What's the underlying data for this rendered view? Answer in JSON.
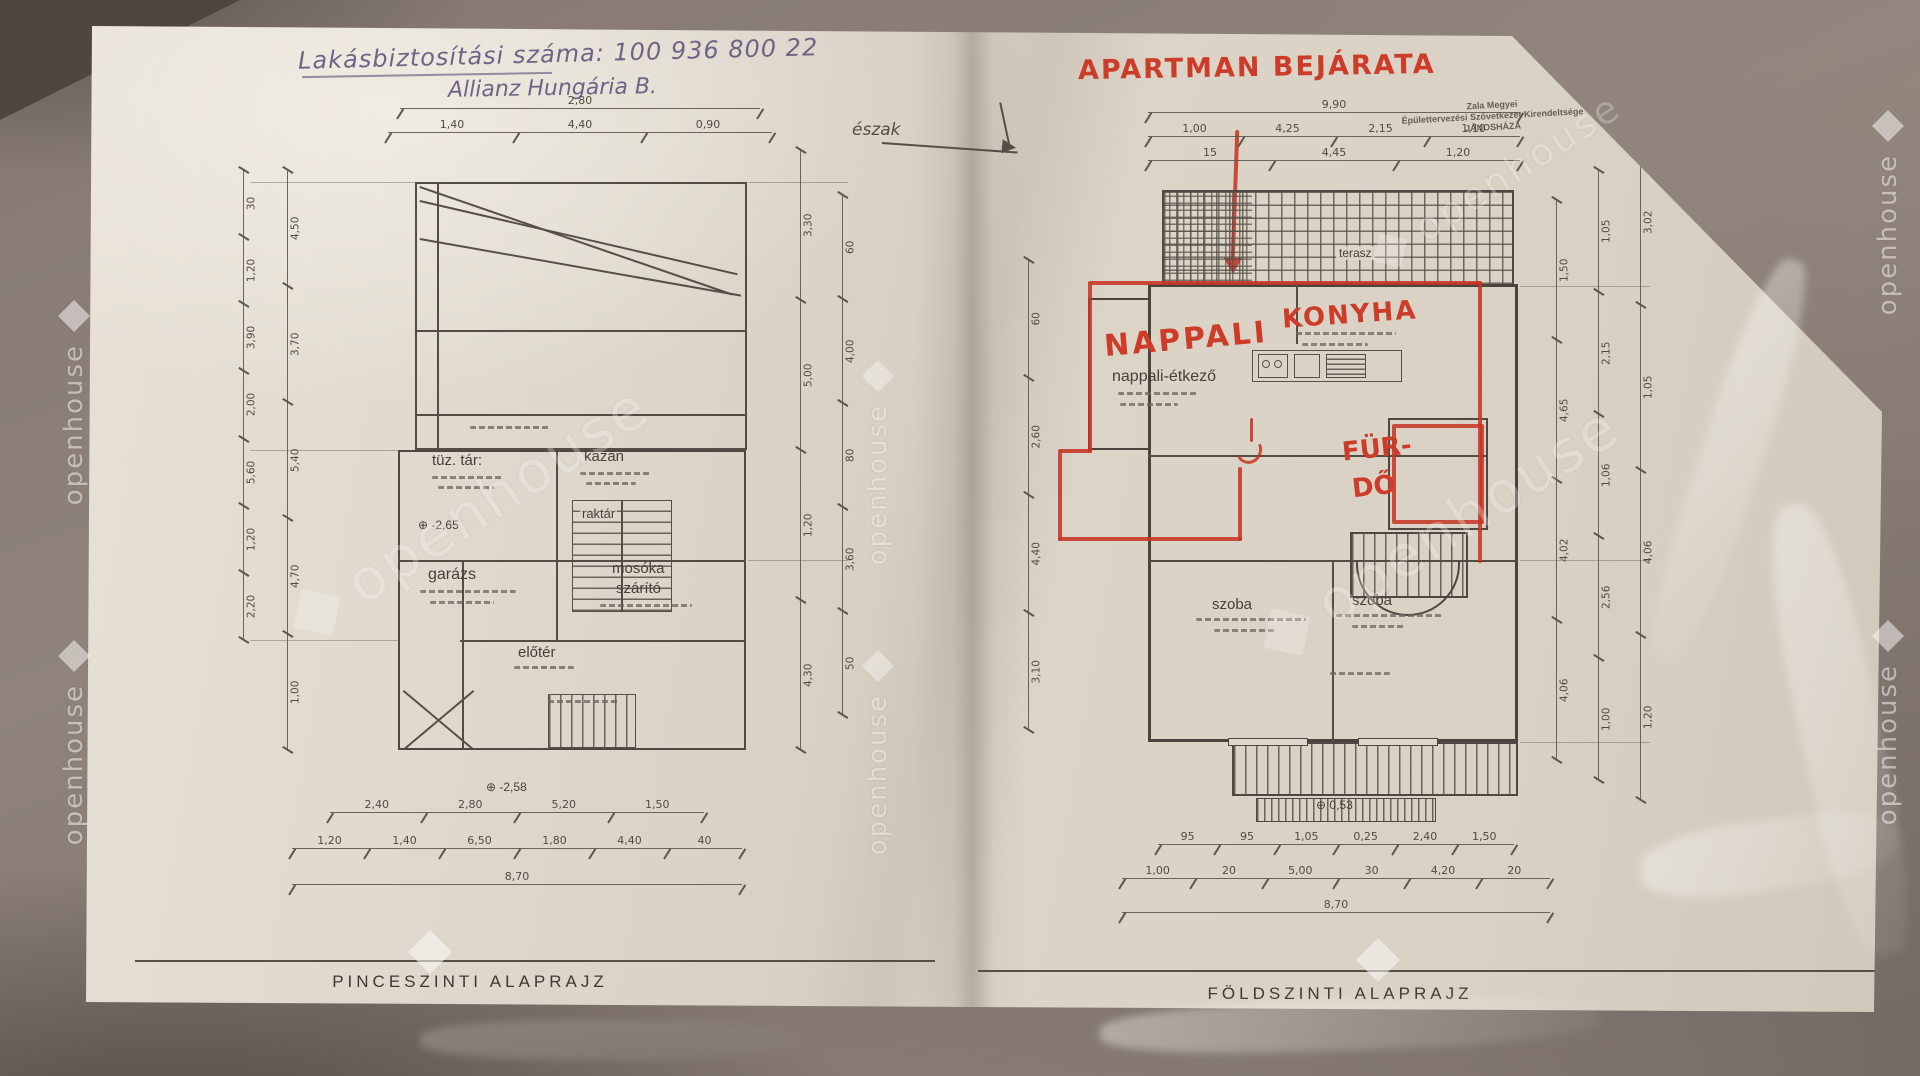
{
  "watermark": {
    "text": "openhouse"
  },
  "handwriting": {
    "line1": "Lakásbiztosítási száma: 100 936 800 22",
    "line2": "Allianz Hungária B."
  },
  "red_annotations": {
    "title": "APARTMAN BEJÁRATA",
    "nappali": "NAPPALI",
    "konyha": "KONYHA",
    "furdo_line1": "FÜR-",
    "furdo_line2": "DŐ"
  },
  "north": {
    "label": "észak"
  },
  "stamp": {
    "line1": "Zala Megyei",
    "line2": "Épülettervezési Szövetkezet Kirendeltsége",
    "line3": "JÁNOSHÁZA"
  },
  "left_plan": {
    "caption": "PINCESZINTI ALAPRAJZ",
    "rooms": {
      "tuztar": "tüz. tár:",
      "kazan": "kazán",
      "raktar": "raktár",
      "garazs": "garázs",
      "mosoka": "mosóka",
      "szarito": "szárító",
      "eloter": "előtér"
    },
    "elevations": {
      "e1": "⊕ -2,65",
      "e2": "⊕ -2,58"
    },
    "dims": {
      "top_row1": [
        "2,80"
      ],
      "top_row2": [
        "1,40",
        "4,40",
        "0,90"
      ],
      "left_outer": [
        "30",
        "1,20",
        "3,90",
        "2,00",
        "5,60",
        "1,20",
        "2,20"
      ],
      "left_inner": [
        "4,50",
        "3,70",
        "5,40",
        "4,70",
        "1,00"
      ],
      "right_outer": [
        "3,30",
        "5,00",
        "1,20",
        "4,30"
      ],
      "right_inner": [
        "60",
        "4,00",
        "80",
        "3,60",
        "50"
      ],
      "bottom_row1": [
        "2,40",
        "2,80",
        "5,20",
        "1,50"
      ],
      "bottom_row2": [
        "1,20",
        "1,40",
        "6,50",
        "1,80",
        "4,40",
        "40"
      ],
      "bottom_total": [
        "8,70"
      ]
    }
  },
  "right_plan": {
    "caption": "FÖLDSZINTI ALAPRAJZ",
    "rooms": {
      "nappali_sub": "nappali-étkező",
      "terasz": "terasz",
      "szoba1": "szoba",
      "szoba2": "szoba"
    },
    "elevations": {
      "e1": "⊕ 0,53"
    },
    "dims": {
      "top_row1": [
        "9,90"
      ],
      "top_row2": [
        "1,00",
        "4,25",
        "2,15",
        "1,10"
      ],
      "top_row3": [
        "15",
        "4,45",
        "1,20"
      ],
      "left_chain": [
        "60",
        "2,60",
        "4,40",
        "3,10"
      ],
      "right_outer": [
        "1,50",
        "4,65",
        "4,02",
        "4,06"
      ],
      "right_mid": [
        "1,05",
        "2,15",
        "1,06",
        "2,56",
        "1,00"
      ],
      "right_inner": [
        "3,02",
        "1,05",
        "4,06",
        "1,20"
      ],
      "bottom_row1": [
        "95",
        "95",
        "1,05",
        "0,25",
        "2,40",
        "1,50"
      ],
      "bottom_row2": [
        "1,00",
        "20",
        "5,00",
        "30",
        "4,20",
        "20"
      ],
      "bottom_total": [
        "8,70"
      ]
    }
  }
}
